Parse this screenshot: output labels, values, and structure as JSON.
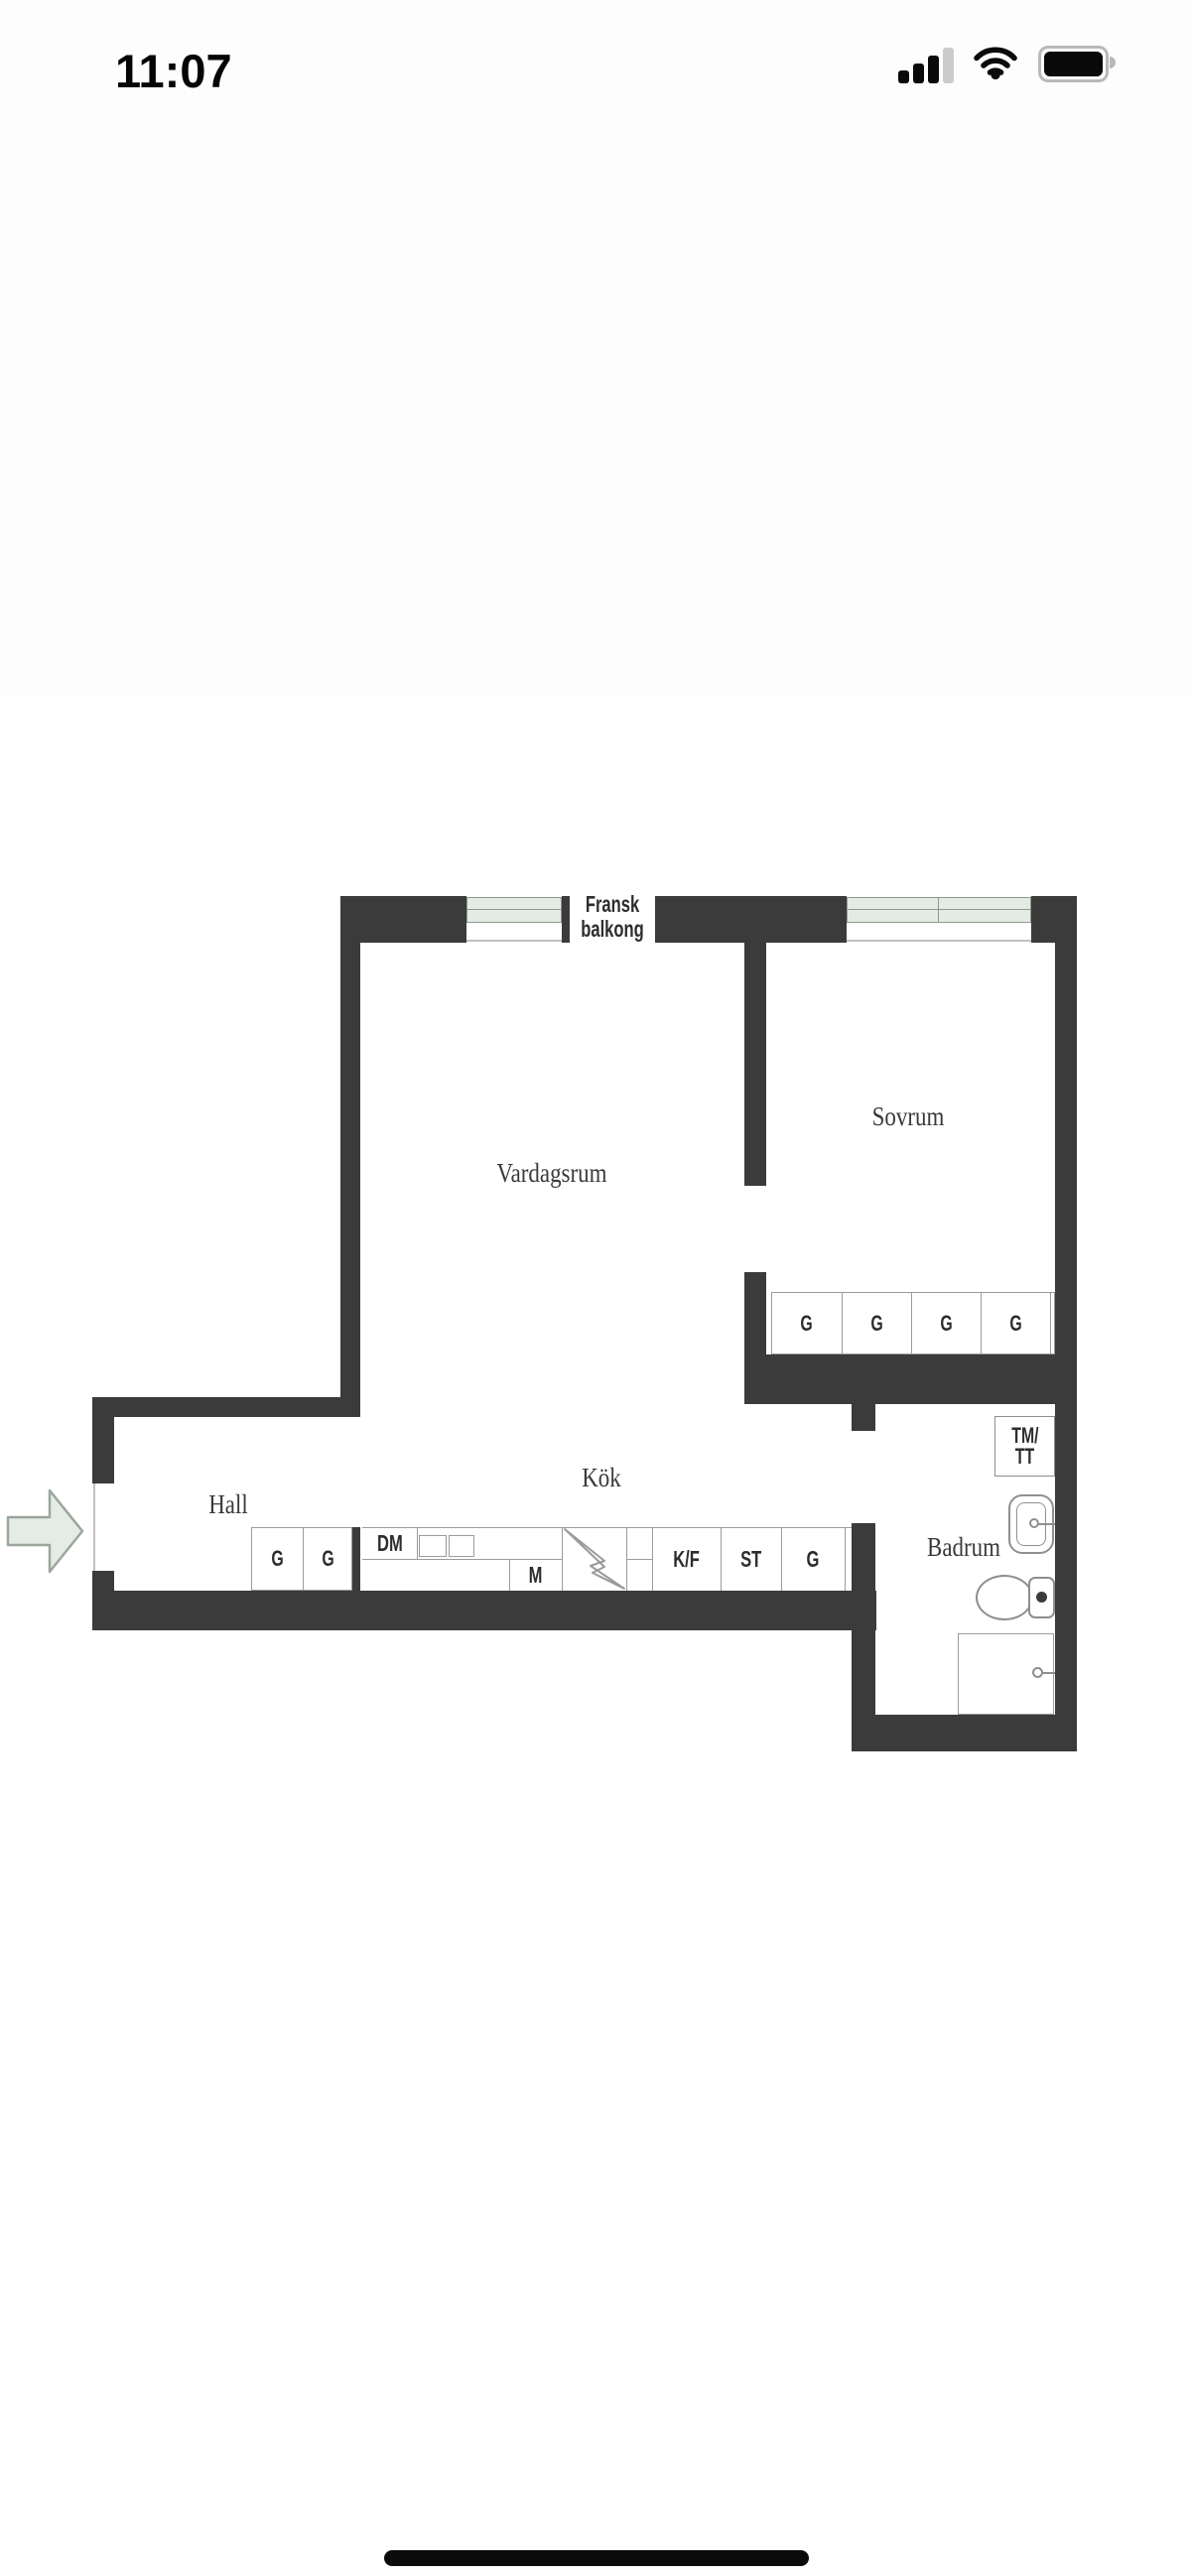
{
  "status_bar": {
    "time": "11:07",
    "icons": {
      "cellular": {
        "name": "cellular-signal-icon",
        "bars_filled": 3,
        "bars_total": 4
      },
      "wifi": {
        "name": "wifi-icon"
      },
      "battery": {
        "name": "battery-icon",
        "state": "full"
      }
    }
  },
  "floor_plan": {
    "balcony_label": "Fransk balkong",
    "rooms": {
      "living_room": "Vardagsrum",
      "bedroom": "Sovrum",
      "kitchen": "Kök",
      "hall": "Hall",
      "bathroom": "Badrum"
    },
    "bedroom_wardrobes": [
      "G",
      "G",
      "G",
      "G"
    ],
    "hall_wardrobes": [
      "G",
      "G"
    ],
    "kitchen_units": {
      "dishwasher": "DM",
      "oven_micro": "M",
      "fridge_freezer": "K/F",
      "tall_cabinet": "ST",
      "cabinet": "G"
    },
    "laundry": {
      "line1": "TM/",
      "line2": "TT"
    },
    "colors": {
      "wall": "#3b3b3b",
      "window_fill": "#e3ebe4",
      "window_border": "#8c9a8e",
      "fixture_line": "#8e8e8e",
      "label_text": "#333333"
    }
  }
}
